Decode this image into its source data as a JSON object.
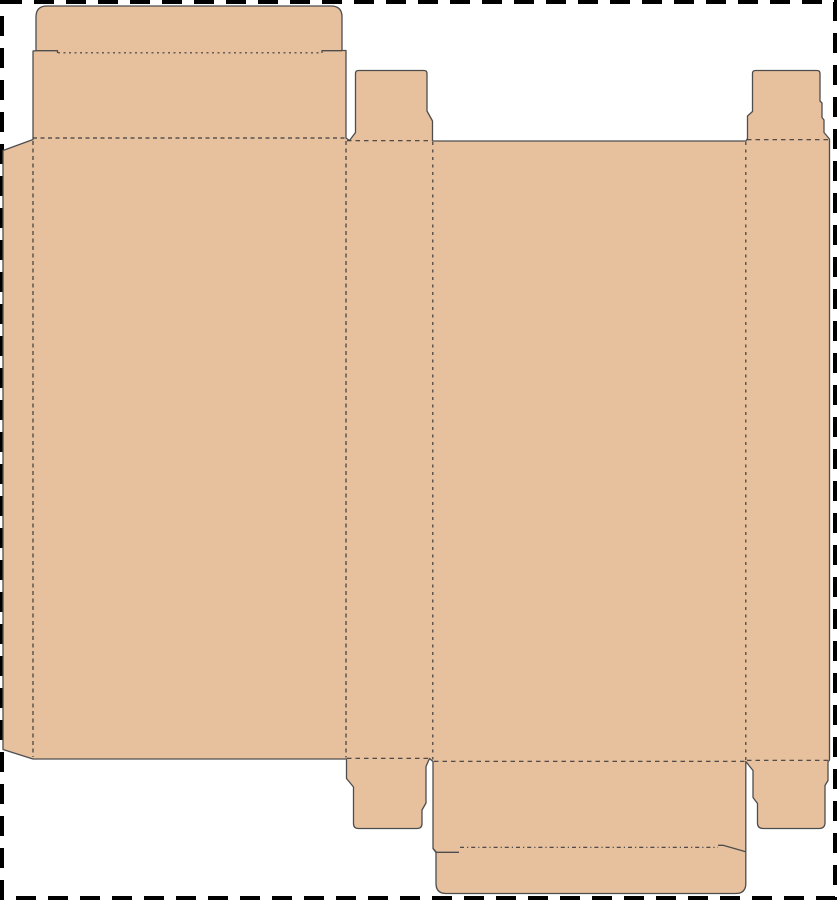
{
  "canvas": {
    "width": 837,
    "height": 900,
    "background": "#ffffff",
    "border": {
      "color": "#000000",
      "dash": "20 12",
      "thickness": 4
    }
  },
  "dieline": {
    "material_fill": "#e7c09e",
    "cut_stroke": "#4d4d4d",
    "fold_stroke": "#3c3c3c",
    "outline_path": "M 36,17 Q 36,6 47,6 L 331,6 Q 342,6 342,17 L 342,50.5 L 346,50.5 L 346,138 L 349.5,140.5 L 355.5,132.5 L 355.5,73.5 Q 355.5,70.5 358.5,70.5 L 424,70.5 Q 427,70.5 427,73.5 L 427,111 L 432.5,121 L 432.5,141 L 746,141 L 747.5,138.5 L 747.5,116 L 752.5,111.5 L 752.5,73.5 Q 752.5,70.5 755.5,70.5 L 817,70.5 Q 820,70.5 820,73.5 L 820,101 L 822,103 L 822,117.5 L 824,120 L 824,132.5 L 829.5,139 L 829.5,760 L 828,762 L 828,780.5 L 825,785.5 L 825,822.5 Q 825,828.5 819,828.5 L 763,828.5 Q 757.5,828.5 757.5,823 L 757.5,803.5 L 753,797.5 L 753,770.5 L 745.8,761.5 L 745.8,883.5 Q 745.8,893.5 735.8,893.5 L 446,893.5 Q 436,893.5 436,883.5 L 436,852.5 L 433,848.5 L 433,761.5 L 429.5,758.5 L 426,766.5 L 426,803 L 422,810 L 422,823.5 Q 422,828.5 417,828.5 L 358.5,828.5 Q 353.5,828.5 353.5,823.5 L 353.5,787 L 346.5,778.5 L 346.5,759 L 33,759 L 3,749.5 L 3,150.5 L 33,139.5 L 33,51 L 36,50.7 Z",
    "slits": [
      {
        "name": "top-lid-left-shoulder-slit",
        "path": "M 36,50.7 L 57.5,50.7 L 57.5,53"
      },
      {
        "name": "top-lid-right-shoulder-slit",
        "path": "M 322,53 L 322,50.7 L 342,50.7"
      },
      {
        "name": "bottom-lid-left-shoulder-slit",
        "path": "M 433,848.5 L 436.5,852.3 L 459,852.3"
      },
      {
        "name": "bottom-lid-right-shoulder-slit",
        "path": "M 718,845.3 L 723,845.3 L 745.8,851.8"
      }
    ],
    "folds": [
      {
        "name": "glue-tab-fold",
        "path": "M 33,141 L 33,757",
        "dash": "4 3.5"
      },
      {
        "name": "left-panel-right-fold",
        "path": "M 346,141 L 346,757.5",
        "dash": "4 3.5"
      },
      {
        "name": "side-panel-right-fold",
        "path": "M 432.8,142 L 432.8,759.5",
        "dash": "3 4.5"
      },
      {
        "name": "front-panel-right-fold",
        "path": "M 745.8,142 L 745.8,760",
        "dash": "3 4.5"
      },
      {
        "name": "top-lid-fold",
        "path": "M 33,138 L 346,138",
        "dash": "4 3.5"
      },
      {
        "name": "top-left-tab-fold",
        "path": "M 347,140.7 L 432,140.7",
        "dash": "4.5 4"
      },
      {
        "name": "top-right-tab-fold",
        "path": "M 747,139.7 L 829,139.7",
        "dash": "4.5 4"
      },
      {
        "name": "top-tuck-fold",
        "path": "M 58,52.8 L 322,52.8",
        "dash": "2 3.5"
      },
      {
        "name": "bottom-left-tab-fold",
        "path": "M 347,758.3 L 429,758.3",
        "dash": "4.5 4"
      },
      {
        "name": "bottom-lid-fold",
        "path": "M 434,761.3 L 745,761.3",
        "dash": "4.5 4"
      },
      {
        "name": "bottom-right-tab-fold",
        "path": "M 747,760.3 L 828,760.3",
        "dash": "4.5 4"
      },
      {
        "name": "bottom-tuck-fold",
        "path": "M 460,847.3 L 718,847.3",
        "dash": "4 3 1.2 3"
      }
    ]
  }
}
